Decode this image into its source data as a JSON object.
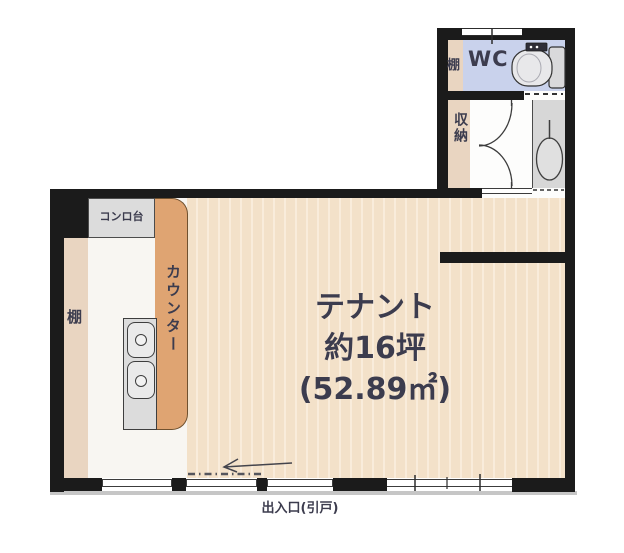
{
  "rooms": {
    "tenant": {
      "name": "テナント",
      "area_tsubo": "約16坪",
      "area_m2": "(52.89㎡)"
    },
    "wc": {
      "name": "WC"
    },
    "storage": {
      "name": "収納"
    }
  },
  "fixtures": {
    "counter": "カウンター",
    "stove_stand": "コンロ台",
    "shelf_kitchen": "棚",
    "shelf_wc": "棚"
  },
  "entrance": {
    "label": "出入口(引戸)"
  },
  "colors": {
    "wall": "#1b1b1b",
    "floor_base": "#f3e1c9",
    "floor_stripe": "#f9ecdb",
    "kitchen_floor": "#f8f6f2",
    "shelf_strip": "#e9d5c1",
    "counter": "#dfa472",
    "wc_floor": "#c9d2ec",
    "wet_area": "#d7d7d7",
    "fixture_gray": "#dcdcdc",
    "text": "#3c3c4e"
  }
}
